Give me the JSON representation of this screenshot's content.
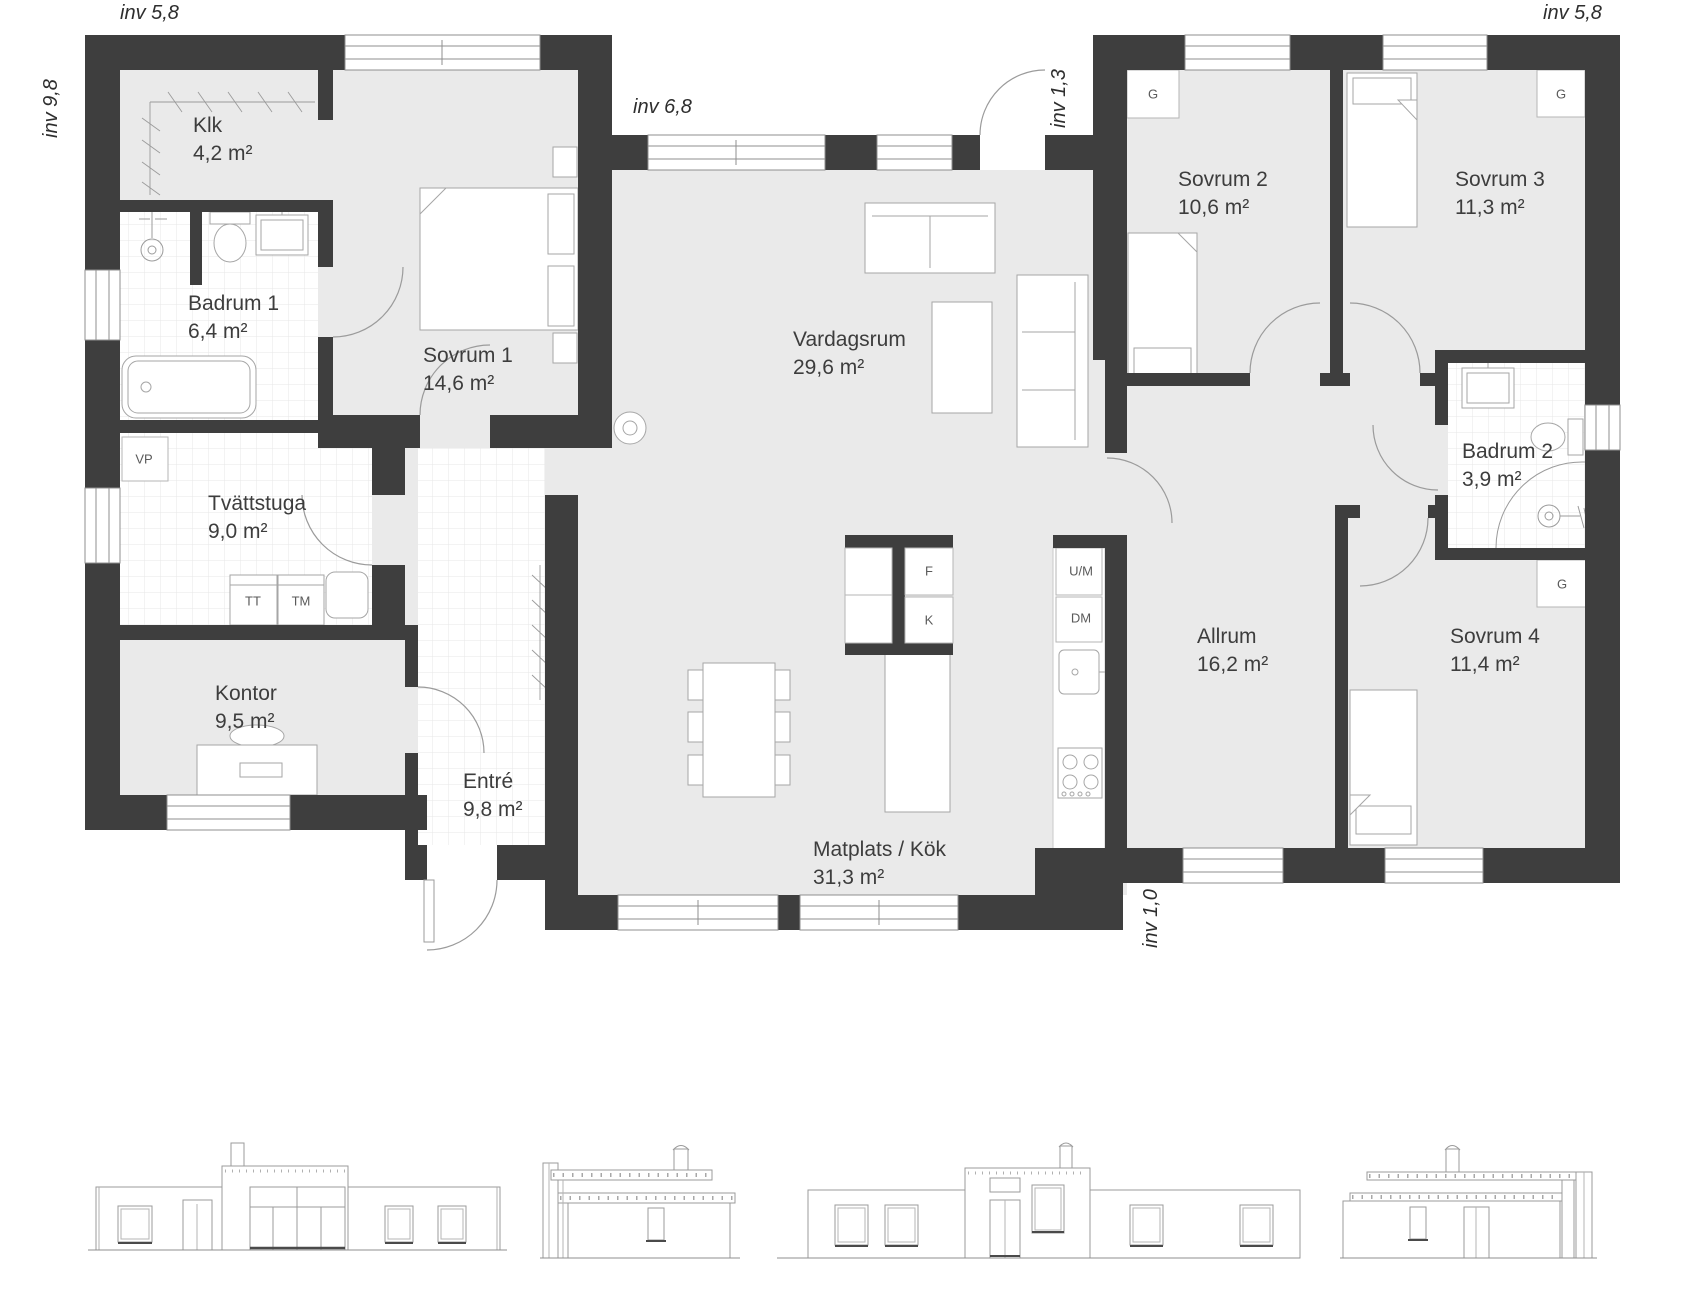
{
  "plan": {
    "dimension_labels": [
      {
        "text": "inv 5,8",
        "position": "top-left"
      },
      {
        "text": "inv 9,8",
        "position": "left-side"
      },
      {
        "text": "inv 6,8",
        "position": "top-center"
      },
      {
        "text": "inv 1,3",
        "position": "entry-recess"
      },
      {
        "text": "inv 5,8",
        "position": "top-right"
      },
      {
        "text": "inv 1,0",
        "position": "bottom-step"
      }
    ],
    "rooms": [
      {
        "name": "Klk",
        "area": "4,2 m²"
      },
      {
        "name": "Badrum 1",
        "area": "6,4 m²"
      },
      {
        "name": "Sovrum 1",
        "area": "14,6 m²"
      },
      {
        "name": "Tvättstuga",
        "area": "9,0 m²"
      },
      {
        "name": "Kontor",
        "area": "9,5 m²"
      },
      {
        "name": "Entré",
        "area": "9,8 m²"
      },
      {
        "name": "Vardagsrum",
        "area": "29,6 m²"
      },
      {
        "name": "Matplats / Kök",
        "area": "31,3 m²"
      },
      {
        "name": "Sovrum 2",
        "area": "10,6 m²"
      },
      {
        "name": "Sovrum 3",
        "area": "11,3 m²"
      },
      {
        "name": "Badrum 2",
        "area": "3,9 m²"
      },
      {
        "name": "Allrum",
        "area": "16,2 m²"
      },
      {
        "name": "Sovrum 4",
        "area": "11,4 m²"
      }
    ],
    "appliance_labels": {
      "vp": "VP",
      "tt": "TT",
      "tm": "TM",
      "f": "F",
      "k": "K",
      "um": "U/M",
      "dm": "DM",
      "g": "G"
    },
    "colors": {
      "wall": "#3e3e3e",
      "floor": "#eaeaea",
      "drawing_line": "#9b9b9b"
    }
  }
}
